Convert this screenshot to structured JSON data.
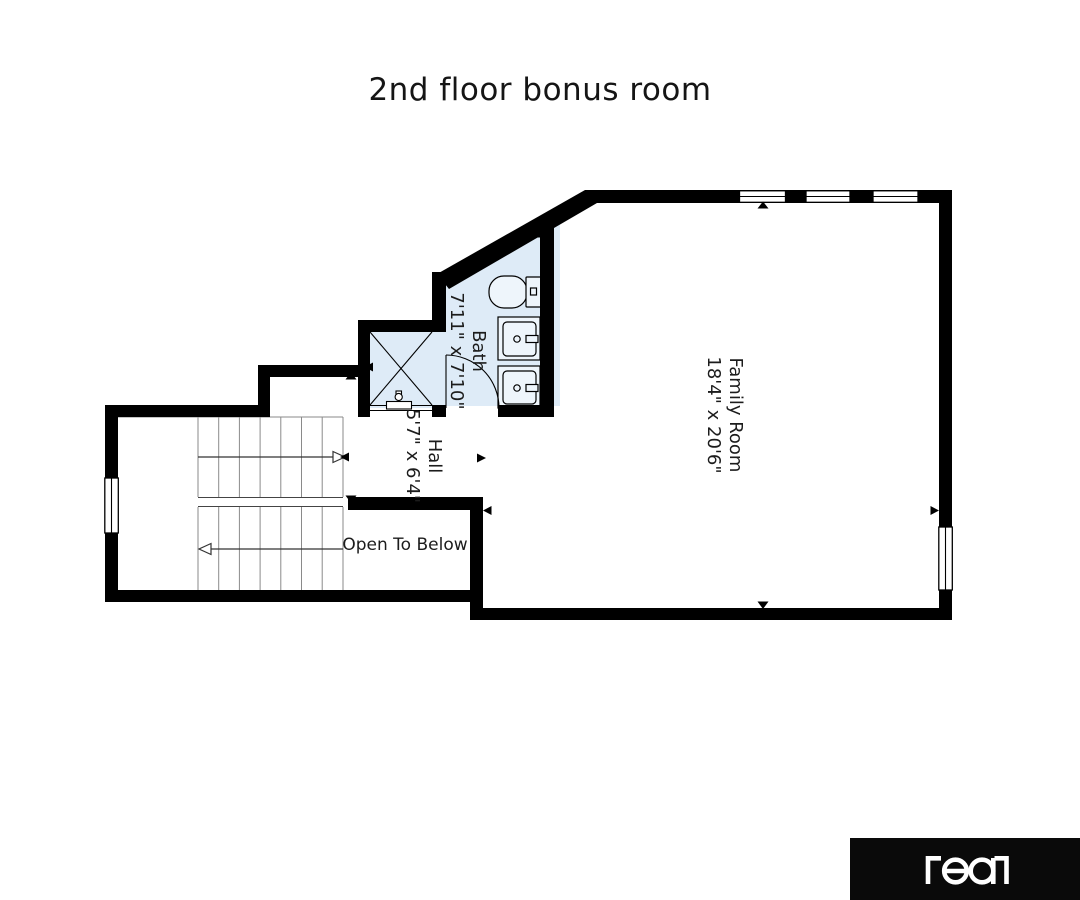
{
  "title": "2nd floor bonus room",
  "plan": {
    "bath": {
      "name": "Bath",
      "dims": "7'11\" x 7'10\""
    },
    "hall": {
      "name": "Hall",
      "dims": "5'7\" x 6'4\""
    },
    "family_room": {
      "name": "Family Room",
      "dims": "18'4\" x 20'6\""
    },
    "open_to_below_label": "Open To Below",
    "fixtures": [
      "toilet",
      "vanity-sink",
      "vanity-sink",
      "shower",
      "door-swing"
    ],
    "stairs": {
      "flights": 2,
      "arrow_directions": [
        "right",
        "left"
      ]
    },
    "windows": {
      "top_wall": 3,
      "left_wall": 1,
      "right_wall": 1
    },
    "colors": {
      "walls": "#000000",
      "wet_area": "#deebf7",
      "stair_lines": "#8a8a8a",
      "label_text": "#1c1c1c"
    }
  },
  "logo": {
    "brand": "real",
    "background": "#0a0a0a",
    "foreground": "#ffffff"
  }
}
